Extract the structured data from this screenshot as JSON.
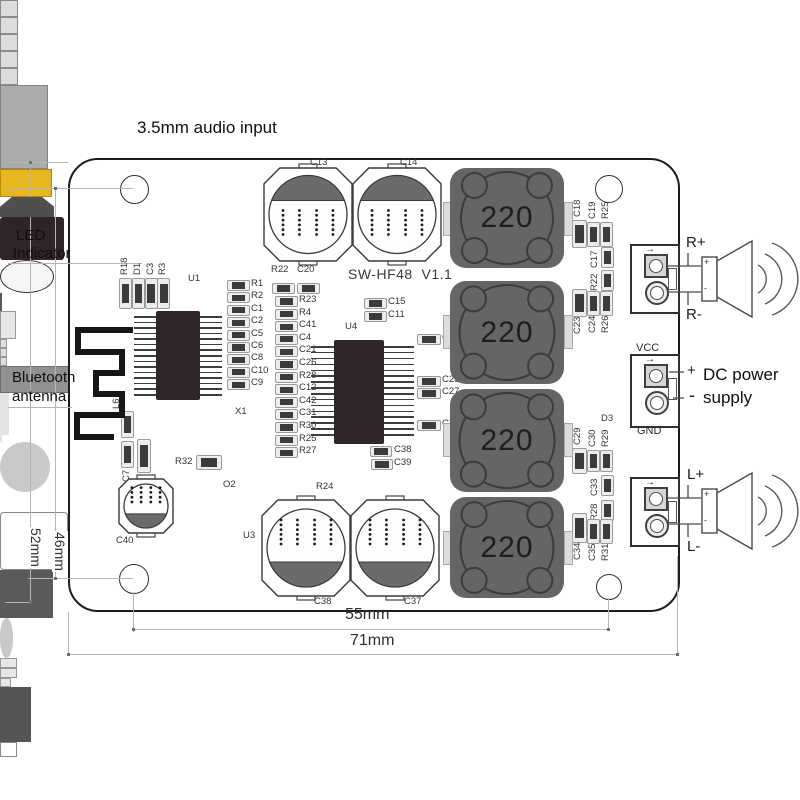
{
  "annotations": {
    "audio_input": "3.5mm audio input",
    "led_line1": "LED",
    "led_line2": "Indicator",
    "bluetooth_line1": "Bluetooth",
    "bluetooth_line2": "antenna",
    "dc_line1": "DC power",
    "dc_line2": "supply"
  },
  "dimensions": {
    "inner_width": "55mm",
    "outer_width": "71mm",
    "outer_height": "52mm",
    "hole_height": "46mm"
  },
  "connectors": {
    "right_speaker_plus": "R+",
    "right_speaker_minus": "R-",
    "left_speaker_plus": "L+",
    "left_speaker_minus": "L-",
    "vcc": "VCC",
    "gnd": "GND",
    "power_side": "POWER",
    "dc_plus": "+",
    "dc_minus": "-",
    "speaker_plus": "+",
    "speaker_minus": "-",
    "wire_arrow_icon": "→"
  },
  "silkscreen": {
    "title": "SW-HF48  V1.1",
    "inductor_value": "220",
    "refs": {
      "jack": "U1",
      "main_ic": "U4",
      "regulator": "U3",
      "crystal": "X1",
      "diode": "D3",
      "transistor": "O2",
      "power_resistor": "R24",
      "r32": "R32",
      "cap_c40": "C40",
      "cap_bottom_left": "C38",
      "cap_bottom_right": "C37",
      "cap_top_left": "C13",
      "cap_top_right": "C14",
      "inductor_l6": "L6",
      "cap_c7": "C7",
      "cap_c5": "C5"
    },
    "led_column": [
      "R18",
      "D1",
      "C3",
      "R3"
    ],
    "column1": [
      "R1",
      "R2",
      "C1",
      "C2",
      "C5",
      "C6",
      "C8",
      "C10",
      "C9"
    ],
    "column2_header": [
      "R22",
      "C20"
    ],
    "column2": [
      "R23",
      "R4",
      "C41",
      "C4",
      "C21",
      "C26",
      "R28",
      "C12",
      "C42",
      "C31",
      "R30",
      "R25",
      "R27"
    ],
    "u4_top": [
      "C15",
      "C11"
    ],
    "u4_bottom": [
      "C38",
      "C39"
    ],
    "u4_right": [
      "C16",
      "C25",
      "C27",
      "C32"
    ],
    "right_top_group": {
      "above": [
        "C18",
        "C19",
        "R25"
      ],
      "mid": [
        "C17",
        "R22"
      ],
      "below": [
        "C23",
        "C24",
        "R26"
      ]
    },
    "right_bottom_group": {
      "above": [
        "C29",
        "C30",
        "R29"
      ],
      "mid": [
        "C33",
        "R28"
      ],
      "below": [
        "C34",
        "C35",
        "R31"
      ]
    }
  },
  "colors": {
    "jack_accent": "#e7b51e",
    "board_outline": "#1c1c1c",
    "inductor_body": "#656565",
    "chip_body": "#2e2527",
    "silk_text": "#333333"
  }
}
